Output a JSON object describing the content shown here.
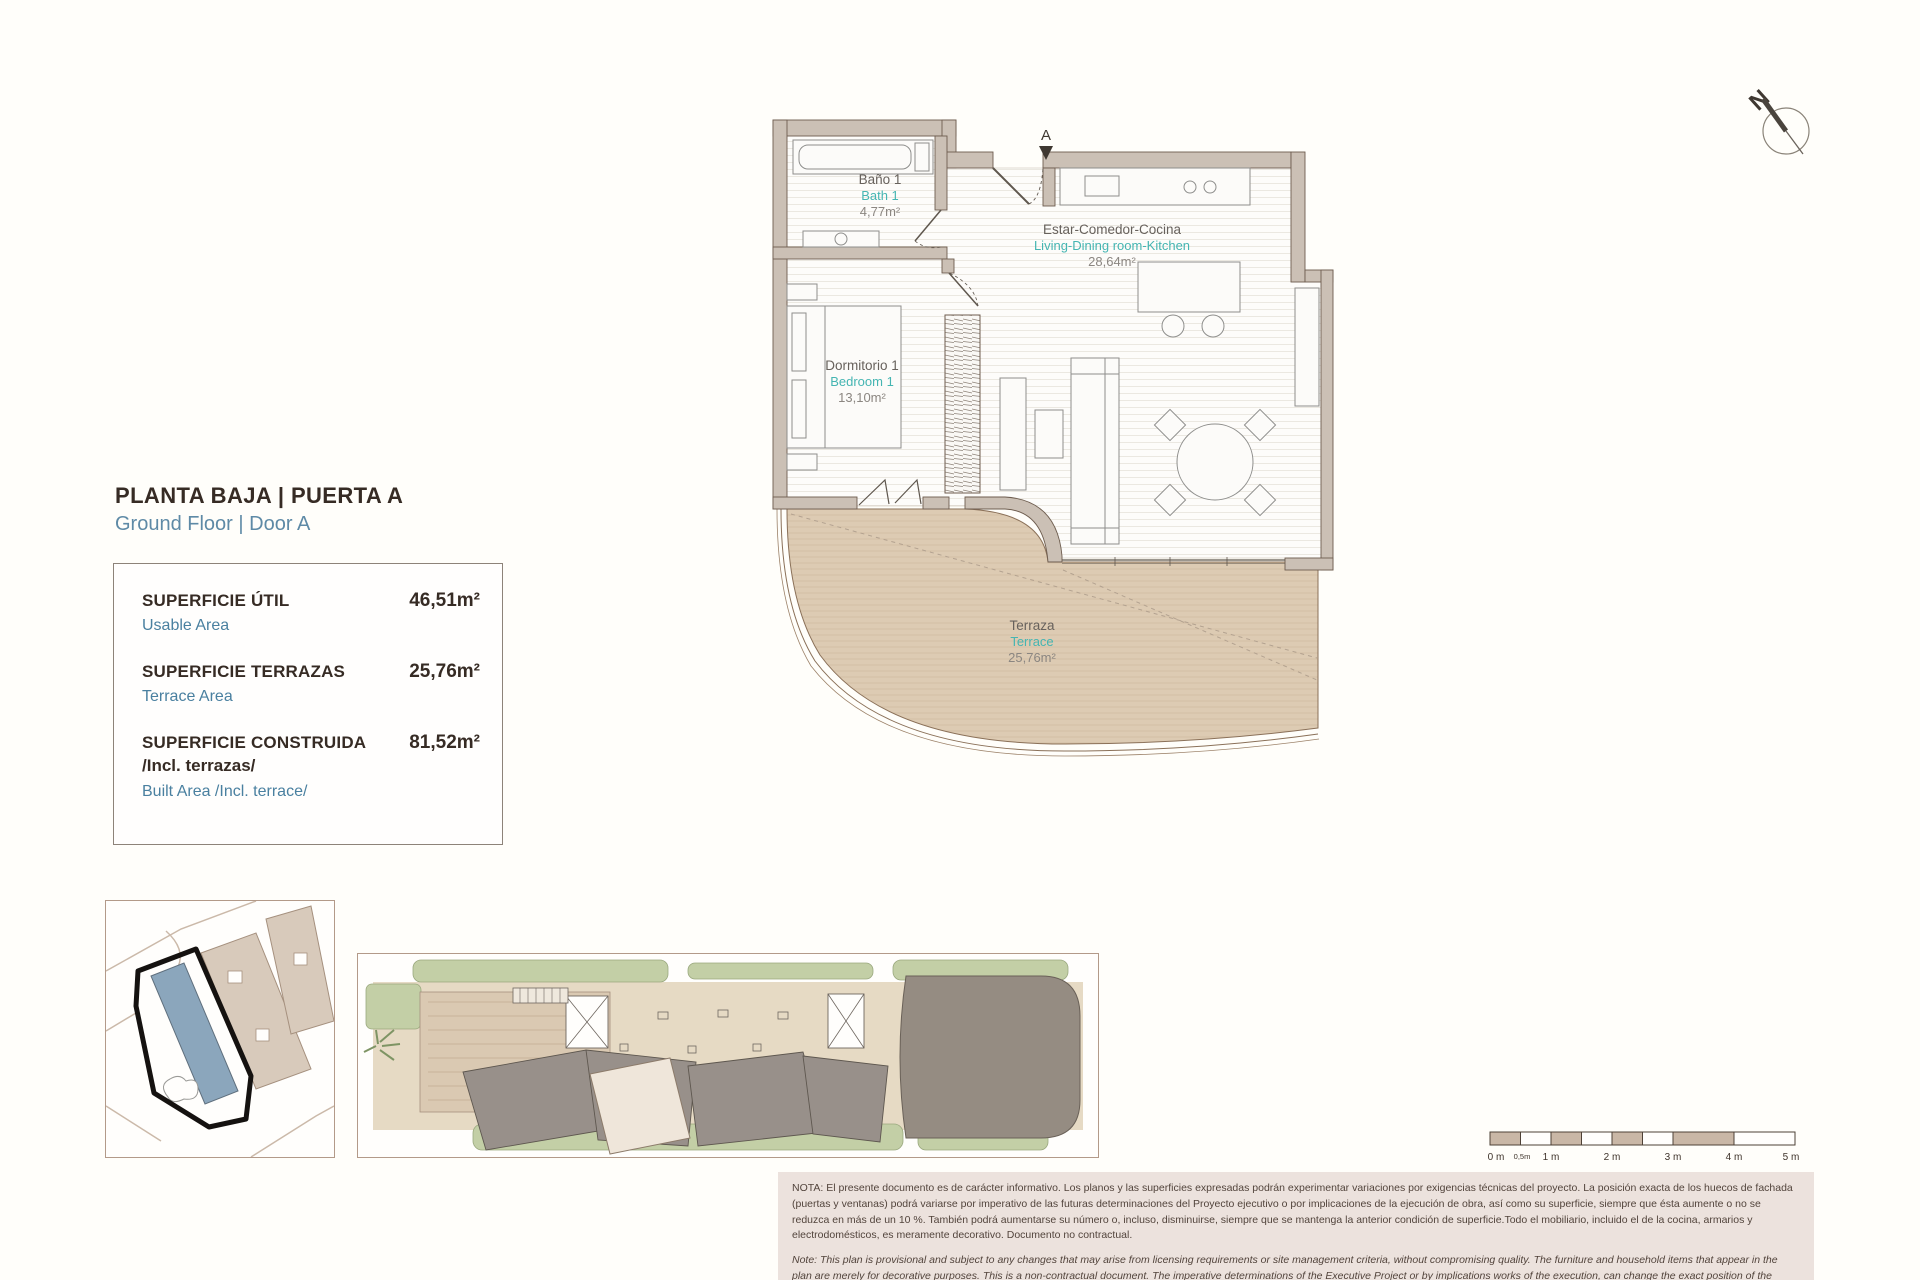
{
  "title": {
    "es": "PLANTA BAJA | PUERTA A",
    "en": "Ground Floor | Door A"
  },
  "area_summary": {
    "rows": [
      {
        "label_es": "SUPERFICIE ÚTIL",
        "label_es2": "",
        "label_en": "Usable Area",
        "value": "46,51m²"
      },
      {
        "label_es": "SUPERFICIE TERRAZAS",
        "label_es2": "",
        "label_en": "Terrace Area",
        "value": "25,76m²"
      },
      {
        "label_es": "SUPERFICIE CONSTRUIDA",
        "label_es2": "/Incl. terrazas/",
        "label_en": "Built Area /Incl. terrace/",
        "value": "81,52m²"
      }
    ]
  },
  "plan": {
    "north_label": "N",
    "entrance_label": "A",
    "rooms": [
      {
        "name_es": "Baño 1",
        "name_en": "Bath 1",
        "area": "4,77m²"
      },
      {
        "name_es": "Estar-Comedor-Cocina",
        "name_en": "Living-Dining room-Kitchen",
        "area": "28,64m²"
      },
      {
        "name_es": "Dormitorio 1",
        "name_en": "Bedroom 1",
        "area": "13,10m²"
      },
      {
        "name_es": "Terraza",
        "name_en": "Terrace",
        "area": "25,76m²"
      }
    ]
  },
  "scale_bar": {
    "labels": [
      "0 m",
      "0,5m",
      "1 m",
      "2 m",
      "3 m",
      "4 m",
      "5 m"
    ]
  },
  "notes": {
    "es": "NOTA: El presente documento es de carácter informativo. Los planos y las superficies expresadas podrán experimentar variaciones por exigencias técnicas del proyecto. La posición exacta de los huecos de fachada (puertas y ventanas) podrá variarse por imperativo de las futuras determinaciones del Proyecto ejecutivo o por implicaciones de la ejecución de obra, así como su superficie, siempre que ésta aumente o no se reduzca en más de un 10 %. También podrá aumentarse su número o, incluso, disminuirse, siempre que se mantenga la anterior condición de superficie.Todo el mobiliario, incluido el de la cocina, armarios y electrodomésticos, es meramente decorativo. Documento no contractual.",
    "en": "Note: This plan is provisional and subject to any changes that may arise from licensing requirements or site management criteria, without compromising quality. The furniture and household items that appear in the plan are merely for decorative purposes. This is a non-contractual document. The imperative determinations of the Executive Project or by implications works of the execution, can change the exact position of the facade of doors and windows, as well the surface area may also be increased or even decrease not more than a 10%.",
    "version": "V.1_JUN-25"
  },
  "colors": {
    "accent_teal": "#45b5b2",
    "accent_blue": "#4a80a0",
    "text_dark": "#362b24",
    "wall_beige": "#cbc0b5",
    "terrace_tan": "#ddcbb3",
    "note_background": "#ece2dd",
    "site_highlight_blue": "#8ba6bc"
  }
}
